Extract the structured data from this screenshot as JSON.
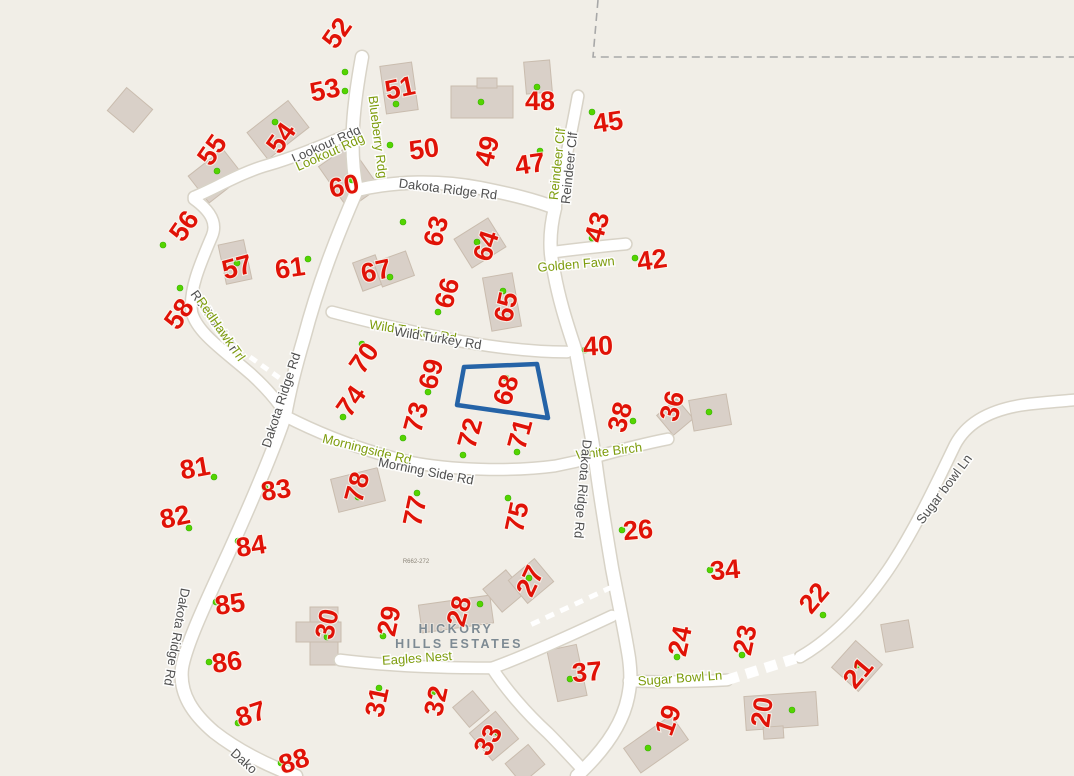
{
  "map": {
    "title_overlay": {
      "line1": "HICKORY",
      "line2": "HILLS ESTATES"
    },
    "survey_note": "R662-272",
    "selected_parcel": "68",
    "parcels": [
      {
        "n": "52"
      },
      {
        "n": "53"
      },
      {
        "n": "51"
      },
      {
        "n": "48"
      },
      {
        "n": "45"
      },
      {
        "n": "50"
      },
      {
        "n": "49"
      },
      {
        "n": "47"
      },
      {
        "n": "54"
      },
      {
        "n": "55"
      },
      {
        "n": "60"
      },
      {
        "n": "56"
      },
      {
        "n": "57"
      },
      {
        "n": "61"
      },
      {
        "n": "58"
      },
      {
        "n": "63"
      },
      {
        "n": "64"
      },
      {
        "n": "67"
      },
      {
        "n": "66"
      },
      {
        "n": "65"
      },
      {
        "n": "43"
      },
      {
        "n": "42"
      },
      {
        "n": "40"
      },
      {
        "n": "70"
      },
      {
        "n": "69"
      },
      {
        "n": "68"
      },
      {
        "n": "74"
      },
      {
        "n": "73"
      },
      {
        "n": "72"
      },
      {
        "n": "71"
      },
      {
        "n": "38"
      },
      {
        "n": "36"
      },
      {
        "n": "81"
      },
      {
        "n": "83"
      },
      {
        "n": "82"
      },
      {
        "n": "84"
      },
      {
        "n": "78"
      },
      {
        "n": "77"
      },
      {
        "n": "75"
      },
      {
        "n": "26"
      },
      {
        "n": "34"
      },
      {
        "n": "85"
      },
      {
        "n": "86"
      },
      {
        "n": "87"
      },
      {
        "n": "88"
      },
      {
        "n": "30"
      },
      {
        "n": "29"
      },
      {
        "n": "28"
      },
      {
        "n": "27"
      },
      {
        "n": "37"
      },
      {
        "n": "31"
      },
      {
        "n": "32"
      },
      {
        "n": "33"
      },
      {
        "n": "24"
      },
      {
        "n": "23"
      },
      {
        "n": "22"
      },
      {
        "n": "21"
      },
      {
        "n": "20"
      },
      {
        "n": "19"
      }
    ],
    "road_labels": [
      {
        "text": "Blueberry Rdg",
        "layer": "green"
      },
      {
        "text": "Lookout Rdg",
        "layer": "gray"
      },
      {
        "text": "Lookout Rdg",
        "layer": "green"
      },
      {
        "text": "Dakota Ridge Rd",
        "layer": "gray"
      },
      {
        "text": "Reindeer Clf",
        "layer": "green"
      },
      {
        "text": "Reindeer Clf",
        "layer": "gray"
      },
      {
        "text": "Golden Fawn",
        "layer": "green"
      },
      {
        "text": "Wild Turkey Rd",
        "layer": "green"
      },
      {
        "text": "Wild Turkey Rd",
        "layer": "gray"
      },
      {
        "text": "Dakota Ridge Rd",
        "layer": "gray"
      },
      {
        "text": "RedHawk Trl",
        "layer": "gray"
      },
      {
        "text": "RedHawk Trl",
        "layer": "green"
      },
      {
        "text": "Morningside Rd",
        "layer": "green"
      },
      {
        "text": "Morning Side Rd",
        "layer": "gray"
      },
      {
        "text": "White Birch",
        "layer": "green"
      },
      {
        "text": "Dakota Ridge Rd",
        "layer": "gray"
      },
      {
        "text": "Eagles Nest",
        "layer": "green"
      },
      {
        "text": "Sugar Bowl Ln",
        "layer": "green"
      },
      {
        "text": "Sugar bowl Ln",
        "layer": "gray"
      },
      {
        "text": "Dakota Ridge Rd",
        "layer": "gray"
      },
      {
        "text": "Dako",
        "layer": "gray"
      }
    ],
    "colors": {
      "background": "#f1eee7",
      "road": "#ffffff",
      "road_casing": "#d8d3c7",
      "building": "#d9d0c8",
      "parcel_number": "#e01207",
      "address_dot": "#55d400",
      "road_label_green": "#7d9c0c",
      "road_label_gray": "#4f4f4f",
      "estate_label": "#7d8a93",
      "selected_outline": "#2563a7",
      "boundary_dash": "#a8a8a8"
    },
    "icons": {
      "address_point": "address-point-dot",
      "selected_parcel": "selected-parcel-outline"
    }
  }
}
